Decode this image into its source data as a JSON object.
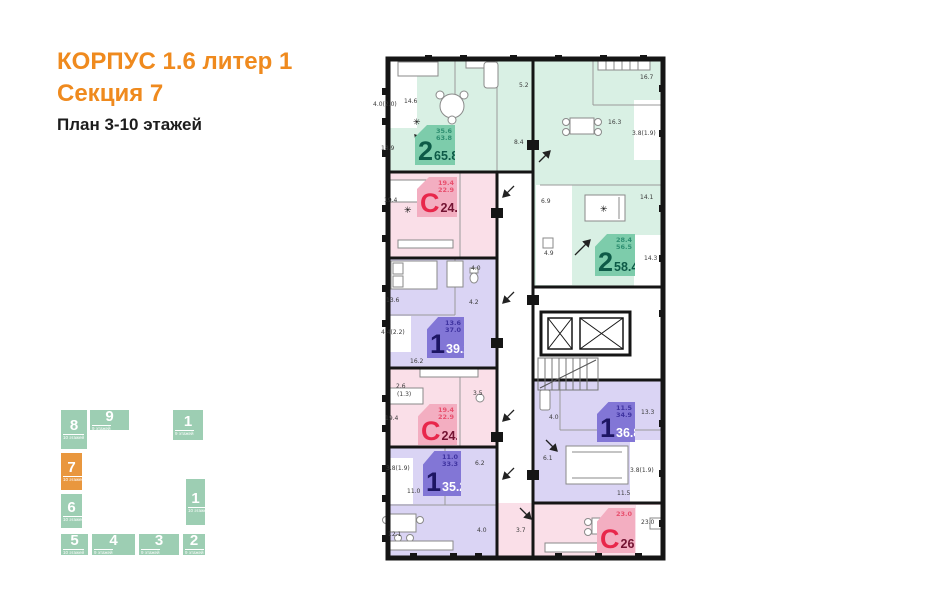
{
  "header": {
    "line1": "КОРПУС 1.6 литер 1",
    "line2": "Секция 7",
    "line3": "План 3-10 этажей"
  },
  "colors": {
    "accent_orange": "#ef8a1e",
    "section_green": "#9dceb3",
    "section_highlight": "#e9973e",
    "apt_green_fill": "#d9f0e4",
    "apt_pink_fill": "#fadfe8",
    "apt_purple_fill": "#dad4f4",
    "badge_green": "#7dccab",
    "badge_pink": "#f3aec1",
    "badge_purple": "#8276d6",
    "badge_red_text": "#e8274b",
    "badge_teal_text": "#0d5a47",
    "badge_navy_text": "#1d1563"
  },
  "icons": {
    "plant": "✳"
  },
  "section_map": {
    "sections": [
      {
        "num": "8",
        "floors": "10 этажей",
        "highlighted": false
      },
      {
        "num": "9",
        "floors": "9 этажей",
        "highlighted": false
      },
      {
        "num": "1",
        "floors": "9 этажей",
        "highlighted": false
      },
      {
        "num": "7",
        "floors": "10 этажей",
        "highlighted": true
      },
      {
        "num": "6",
        "floors": "10 этажей",
        "highlighted": false
      },
      {
        "num": "1",
        "floors": "10 этажей",
        "highlighted": false
      },
      {
        "num": "5",
        "floors": "10 этажей",
        "highlighted": false
      },
      {
        "num": "4",
        "floors": "9 этажей",
        "highlighted": false
      },
      {
        "num": "3",
        "floors": "9 этажей",
        "highlighted": false
      },
      {
        "num": "2",
        "floors": "9 этажей",
        "highlighted": false
      }
    ]
  },
  "apartments": [
    {
      "type": "2",
      "area": "65.8",
      "sub1": "35.6",
      "sub2": "63.8"
    },
    {
      "type": "С",
      "area": "24.2",
      "sub1": "19.4",
      "sub2": "22.9"
    },
    {
      "type": "2",
      "area": "58.4",
      "sub1": "28.4",
      "sub2": "56.5"
    },
    {
      "type": "1",
      "area": "39.2",
      "sub1": "13.6",
      "sub2": "37.0"
    },
    {
      "type": "С",
      "area": "24.2",
      "sub1": "19.4",
      "sub2": "22.9"
    },
    {
      "type": "1",
      "area": "35.2",
      "sub1": "11.0",
      "sub2": "33.3"
    },
    {
      "type": "1",
      "area": "36.8",
      "sub1": "11.5",
      "sub2": "34.9"
    },
    {
      "type": "С",
      "area": "26.7",
      "sub1": "23.0",
      "sub2": ""
    }
  ],
  "room_labels": [
    {
      "text": "14.6"
    },
    {
      "text": "4.0(2.0)"
    },
    {
      "text": "18.9"
    },
    {
      "text": "5.2"
    },
    {
      "text": "16.7"
    },
    {
      "text": "16.3"
    },
    {
      "text": "3.8(1.9)"
    },
    {
      "text": "8.4"
    },
    {
      "text": "6.9"
    },
    {
      "text": "14.1"
    },
    {
      "text": "14.3"
    },
    {
      "text": "4.9"
    },
    {
      "text": "19.4"
    },
    {
      "text": "13.6"
    },
    {
      "text": "4.0"
    },
    {
      "text": "4.2"
    },
    {
      "text": "4.4(2.2)"
    },
    {
      "text": "16.2"
    },
    {
      "text": "2.6"
    },
    {
      "text": "(1.3)"
    },
    {
      "text": "3.5"
    },
    {
      "text": "19.4"
    },
    {
      "text": "3.8(1.9)"
    },
    {
      "text": "11.0"
    },
    {
      "text": "12.1"
    },
    {
      "text": "4.0"
    },
    {
      "text": "3.7"
    },
    {
      "text": "6.2"
    },
    {
      "text": "6.1"
    },
    {
      "text": "4.0"
    },
    {
      "text": "13.3"
    },
    {
      "text": "3.8(1.9)"
    },
    {
      "text": "11.5"
    },
    {
      "text": "23.0"
    }
  ]
}
